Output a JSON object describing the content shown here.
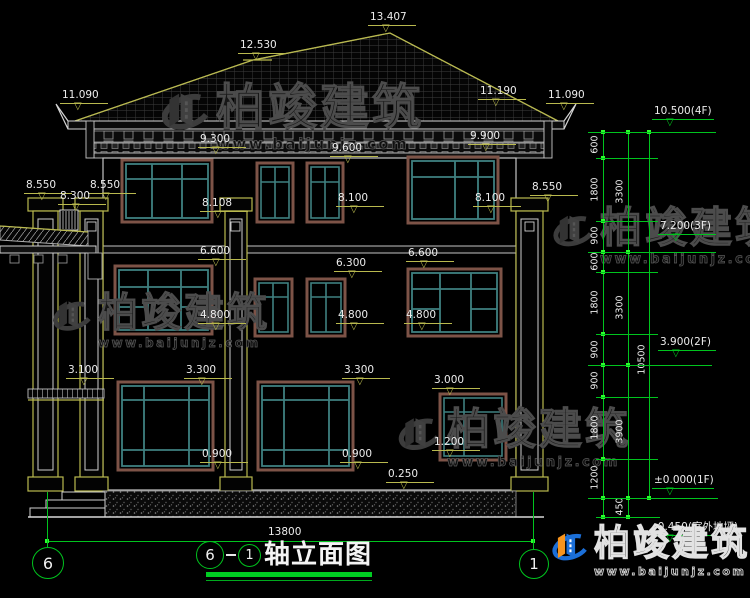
{
  "brand": {
    "name": "柏竣建筑",
    "url": "www.baijunjz.com"
  },
  "title_block": {
    "axis_a": "6",
    "axis_b": "1",
    "label": "轴立面图"
  },
  "axis_bubbles": [
    {
      "n": "6",
      "cx": 47,
      "cy": 562,
      "r": 15
    },
    {
      "n": "1",
      "cx": 533,
      "cy": 563,
      "r": 14
    }
  ],
  "level_markers": [
    {
      "t": "13.407",
      "x": 368,
      "y": 12
    },
    {
      "t": "12.530",
      "x": 238,
      "y": 40
    },
    {
      "t": "11.090",
      "x": 60,
      "y": 90
    },
    {
      "t": "11.190",
      "x": 478,
      "y": 86
    },
    {
      "t": "11.090",
      "x": 546,
      "y": 90
    },
    {
      "t": "9.300",
      "x": 198,
      "y": 134
    },
    {
      "t": "9.600",
      "x": 330,
      "y": 143
    },
    {
      "t": "9.900",
      "x": 468,
      "y": 131
    },
    {
      "t": "8.550",
      "x": 24,
      "y": 180
    },
    {
      "t": "8.550",
      "x": 88,
      "y": 180
    },
    {
      "t": "8.300",
      "x": 58,
      "y": 191
    },
    {
      "t": "8.550",
      "x": 530,
      "y": 182
    },
    {
      "t": "8.108",
      "x": 200,
      "y": 198
    },
    {
      "t": "8.100",
      "x": 336,
      "y": 193
    },
    {
      "t": "8.100",
      "x": 473,
      "y": 193
    },
    {
      "t": "6.600",
      "x": 198,
      "y": 246
    },
    {
      "t": "6.300",
      "x": 334,
      "y": 258
    },
    {
      "t": "6.600",
      "x": 406,
      "y": 248
    },
    {
      "t": "4.800",
      "x": 198,
      "y": 310
    },
    {
      "t": "4.800",
      "x": 336,
      "y": 310
    },
    {
      "t": "4.800",
      "x": 404,
      "y": 310
    },
    {
      "t": "3.300",
      "x": 184,
      "y": 365
    },
    {
      "t": "3.300",
      "x": 342,
      "y": 365
    },
    {
      "t": "3.100",
      "x": 66,
      "y": 365
    },
    {
      "t": "3.000",
      "x": 432,
      "y": 375
    },
    {
      "t": "1.200",
      "x": 432,
      "y": 437
    },
    {
      "t": "0.900",
      "x": 200,
      "y": 449
    },
    {
      "t": "0.900",
      "x": 340,
      "y": 449
    },
    {
      "t": "0.250",
      "x": 386,
      "y": 469
    },
    {
      "t": "10.500(4F)",
      "x": 652,
      "y": 106,
      "c": "g",
      "w": 62
    },
    {
      "t": "7.200(3F)",
      "x": 658,
      "y": 221,
      "c": "g",
      "w": 58
    },
    {
      "t": "3.900(2F)",
      "x": 658,
      "y": 337,
      "c": "g",
      "w": 58
    },
    {
      "t": "±0.000(1F)",
      "x": 652,
      "y": 475,
      "c": "g",
      "w": 62
    },
    {
      "t": "-0.450(室外地坪)",
      "x": 652,
      "y": 522,
      "c": "g",
      "w": 62
    }
  ],
  "dims": {
    "chains": [
      {
        "x": 603,
        "lx": 595,
        "y1": 132,
        "y2": 517,
        "ticks": [
          132,
          158,
          221,
          252,
          272,
          334,
          365,
          397,
          459,
          498,
          517
        ],
        "labels": [
          {
            "t": "600",
            "y": 145
          },
          {
            "t": "1800",
            "y": 190
          },
          {
            "t": "900",
            "y": 236
          },
          {
            "t": "600",
            "y": 262
          },
          {
            "t": "1800",
            "y": 303
          },
          {
            "t": "900",
            "y": 350
          },
          {
            "t": "900",
            "y": 381
          },
          {
            "t": "1800",
            "y": 428
          },
          {
            "t": "1200",
            "y": 478
          }
        ]
      },
      {
        "x": 628,
        "lx": 620,
        "y1": 132,
        "y2": 517,
        "ticks": [
          132,
          252,
          365,
          498,
          517
        ],
        "labels": [
          {
            "t": "3300",
            "y": 192
          },
          {
            "t": "3300",
            "y": 308
          },
          {
            "t": "3900",
            "y": 432
          },
          {
            "t": "450",
            "y": 507
          }
        ]
      },
      {
        "x": 649,
        "lx": 642,
        "y1": 132,
        "y2": 498,
        "ticks": [
          132,
          498
        ],
        "labels": [
          {
            "t": "10500",
            "y": 360
          }
        ]
      }
    ],
    "level_lines": [
      {
        "y": 132,
        "x1": 588,
        "x2": 716
      },
      {
        "y": 252,
        "x1": 588,
        "x2": 716
      },
      {
        "y": 365,
        "x1": 588,
        "x2": 712
      },
      {
        "y": 498,
        "x1": 588,
        "x2": 718
      }
    ],
    "minor_lines": [
      {
        "y": 158,
        "x1": 596,
        "x2": 658
      },
      {
        "y": 221,
        "x1": 596,
        "x2": 658
      },
      {
        "y": 272,
        "x1": 596,
        "x2": 658
      },
      {
        "y": 334,
        "x1": 596,
        "x2": 658
      },
      {
        "y": 397,
        "x1": 596,
        "x2": 658
      },
      {
        "y": 459,
        "x1": 596,
        "x2": 658
      },
      {
        "y": 517,
        "x1": 596,
        "x2": 660
      }
    ],
    "width_dim": {
      "text": "13800",
      "tx": 268,
      "ty": 526,
      "y": 541,
      "x1": 47,
      "x2": 533
    },
    "leaders": [
      {
        "x": 47,
        "y1": 492,
        "y2": 547
      },
      {
        "x": 533,
        "y1": 492,
        "y2": 549
      }
    ]
  },
  "watermarks": [
    {
      "x": 152,
      "y": 82,
      "scale": 1.12,
      "style": "grey"
    },
    {
      "x": 545,
      "y": 206,
      "scale": 0.95,
      "style": "grey"
    },
    {
      "x": 45,
      "y": 292,
      "scale": 0.9,
      "style": "grey"
    },
    {
      "x": 390,
      "y": 408,
      "scale": 0.98,
      "style": "grey"
    },
    {
      "x": 545,
      "y": 525,
      "scale": 0.82,
      "style": "color"
    }
  ],
  "colors": {
    "background": "#000000",
    "linework": "#d0d0d0",
    "cad_yellow": "#b9b94e",
    "dim_green": "#00c41e",
    "tick_green": "#2bff2b",
    "window_teal": "#3f8080",
    "window_frame_brown": "#7d5347",
    "logo_blue": "#1b6fd8",
    "logo_orange": "#f7941d"
  }
}
